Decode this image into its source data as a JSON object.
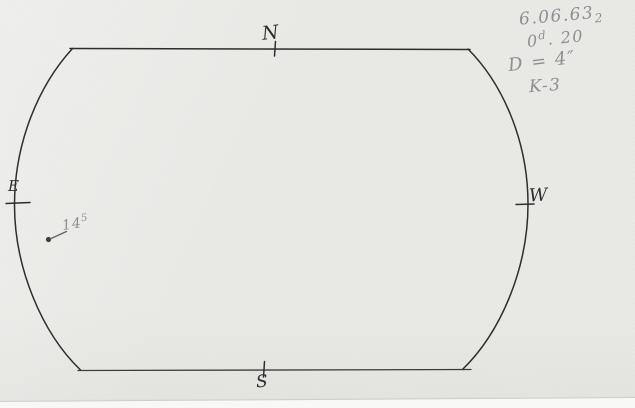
{
  "compass": {
    "north": "N",
    "east": "E",
    "south": "S",
    "west": "W"
  },
  "spot_label": {
    "base": "14",
    "sup": "5"
  },
  "notes": {
    "date": "6.06.63",
    "date_sub": "2",
    "time_base": "0",
    "time_sup": "d",
    "time_rest": ". 20",
    "aperture": "D = 4″",
    "code": "K-3"
  },
  "colors": {
    "paper": "#e9e9e6",
    "ink": "#2e2e2e",
    "pencil": "#8f8f93",
    "scan_strip": "#f8f8f7"
  }
}
